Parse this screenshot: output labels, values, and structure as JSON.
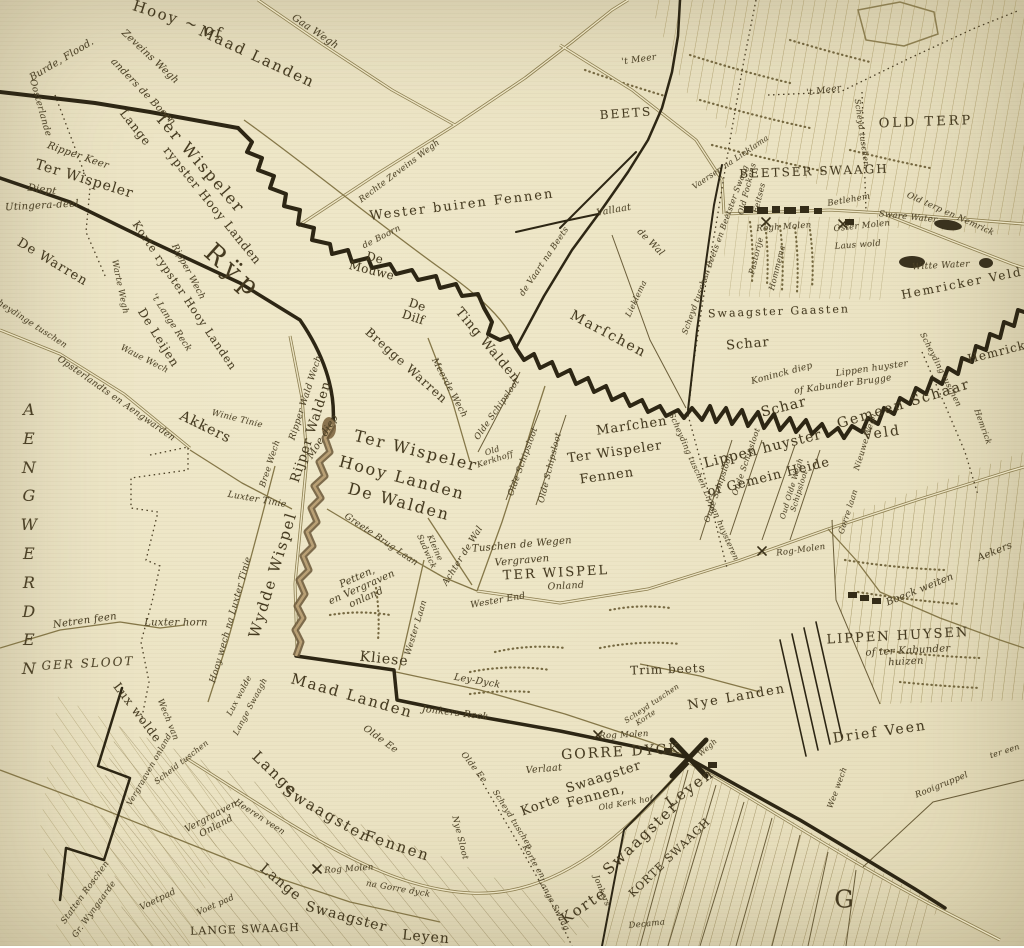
{
  "colors": {
    "paper": "#ebe3c3",
    "ink": "#453a20",
    "dark": "#2d2614",
    "road": "#8c7e50",
    "hatch": "#a08f58",
    "stream": "#6d5a3a"
  },
  "labels": [
    {
      "t": "Hooy ~ of",
      "x": 178,
      "y": 20,
      "r": 18,
      "s": 15,
      "ls": 2
    },
    {
      "t": "Maad Landen",
      "x": 257,
      "y": 57,
      "r": 25,
      "s": 15,
      "ls": 2
    },
    {
      "t": "Gaa Wegh",
      "x": 315,
      "y": 32,
      "r": 34,
      "s": 10,
      "i": 1
    },
    {
      "t": "Burde, Flood.",
      "x": 62,
      "y": 60,
      "r": -31,
      "s": 10,
      "i": 1
    },
    {
      "t": "Zeveins Wegh",
      "x": 150,
      "y": 57,
      "r": 43,
      "s": 10,
      "i": 1
    },
    {
      "t": "anders de Boorn",
      "x": 143,
      "y": 92,
      "r": 46,
      "s": 10,
      "i": 1
    },
    {
      "t": "Oosterlande",
      "x": 40,
      "y": 108,
      "r": 74,
      "s": 9,
      "i": 1
    },
    {
      "t": "Ripper Keer",
      "x": 78,
      "y": 156,
      "r": 19,
      "s": 10,
      "i": 1
    },
    {
      "t": "Ter Wispeler",
      "x": 84,
      "y": 180,
      "r": 17,
      "s": 14,
      "ls": 1
    },
    {
      "t": "Lange",
      "x": 135,
      "y": 128,
      "r": 52,
      "s": 12,
      "ls": 1
    },
    {
      "t": "Ter Wispeler",
      "x": 200,
      "y": 163,
      "r": 49,
      "s": 16,
      "ls": 2
    },
    {
      "t": "rypster Hooy Landen",
      "x": 212,
      "y": 206,
      "r": 51,
      "s": 12,
      "ls": 1
    },
    {
      "t": "Korte rypster Hooy Landen",
      "x": 184,
      "y": 296,
      "r": 56,
      "s": 11,
      "ls": 1
    },
    {
      "t": "'t Lange Reck",
      "x": 171,
      "y": 323,
      "r": 57,
      "s": 9,
      "i": 1
    },
    {
      "t": "Ripper Wech",
      "x": 188,
      "y": 272,
      "r": 62,
      "s": 9,
      "i": 1
    },
    {
      "t": "Diept",
      "x": 42,
      "y": 190,
      "r": 8,
      "s": 10,
      "i": 1
    },
    {
      "t": "Utingera-deel",
      "x": 42,
      "y": 206,
      "r": -3,
      "s": 10,
      "i": 1
    },
    {
      "t": "De Warren",
      "x": 52,
      "y": 263,
      "r": 31,
      "s": 13,
      "ls": 1
    },
    {
      "t": "Rÿp",
      "x": 233,
      "y": 272,
      "r": 42,
      "s": 26,
      "ls": 6
    },
    {
      "t": "De Leijen",
      "x": 158,
      "y": 338,
      "r": 58,
      "s": 12,
      "ls": 1
    },
    {
      "t": "Warte Wegh",
      "x": 119,
      "y": 287,
      "r": 78,
      "s": 8.5,
      "i": 1
    },
    {
      "t": "Waue Wech",
      "x": 144,
      "y": 360,
      "r": 27,
      "s": 8.5,
      "i": 1
    },
    {
      "t": "Scheydinge tuschen",
      "x": 27,
      "y": 322,
      "r": 33,
      "s": 8.5,
      "i": 1
    },
    {
      "t": "Opsterlandts en Aengwarden",
      "x": 116,
      "y": 399,
      "r": 35,
      "s": 9,
      "i": 1
    },
    {
      "t": "Akkers",
      "x": 205,
      "y": 428,
      "r": 26,
      "s": 14,
      "ls": 1
    },
    {
      "t": "Winie Tinie",
      "x": 237,
      "y": 420,
      "r": 14,
      "s": 8.5,
      "i": 1
    },
    {
      "t": "Bree Wech",
      "x": 271,
      "y": 464,
      "r": -72,
      "s": 8.5,
      "i": 1
    },
    {
      "t": "Ripper Wald Wech",
      "x": 306,
      "y": 398,
      "r": -72,
      "s": 9,
      "i": 1
    },
    {
      "t": "Rijper Walden",
      "x": 312,
      "y": 432,
      "r": -72,
      "s": 13,
      "ls": 1
    },
    {
      "t": "Moe diep",
      "x": 323,
      "y": 437,
      "r": -58,
      "s": 10,
      "i": 1
    },
    {
      "t": "Wydde Wispel",
      "x": 273,
      "y": 575,
      "r": -73,
      "s": 15,
      "ls": 2
    },
    {
      "t": "Luxter Tinie",
      "x": 257,
      "y": 500,
      "r": 10,
      "s": 9,
      "i": 1
    },
    {
      "t": "Hooy wech na Luxter Tinie",
      "x": 231,
      "y": 620,
      "r": -74,
      "s": 9,
      "i": 1
    },
    {
      "t": "Luxter horn",
      "x": 176,
      "y": 623,
      "r": 0,
      "s": 10,
      "i": 1
    },
    {
      "t": "Netren feen",
      "x": 85,
      "y": 621,
      "r": -8,
      "s": 10,
      "i": 1
    },
    {
      "t": "GER SLOOT",
      "x": 88,
      "y": 664,
      "r": -3,
      "s": 12,
      "ls": 2,
      "i": 1
    },
    {
      "t": "Lux wolde",
      "x": 137,
      "y": 713,
      "r": 53,
      "s": 12,
      "ls": 1
    },
    {
      "t": "Wech van",
      "x": 167,
      "y": 720,
      "r": 68,
      "s": 8.5,
      "i": 1
    },
    {
      "t": "Scheid tuschen",
      "x": 182,
      "y": 763,
      "r": -38,
      "s": 8,
      "i": 1
    },
    {
      "t": "Vergraaven\nOnland",
      "x": 214,
      "y": 822,
      "r": -28,
      "s": 9.5,
      "i": 1
    },
    {
      "t": "Vergraaven onland",
      "x": 150,
      "y": 770,
      "r": -60,
      "s": 8,
      "i": 1
    },
    {
      "t": "Statten Roschen",
      "x": 86,
      "y": 893,
      "r": -54,
      "s": 8.5,
      "i": 1
    },
    {
      "t": "Gr. Wyngaarde",
      "x": 95,
      "y": 910,
      "r": -54,
      "s": 8.5,
      "i": 1
    },
    {
      "t": "Voetpad",
      "x": 158,
      "y": 900,
      "r": -26,
      "s": 9,
      "i": 1
    },
    {
      "t": "Maad Landen",
      "x": 352,
      "y": 696,
      "r": 16,
      "s": 15,
      "ls": 2
    },
    {
      "t": "Olde Ee",
      "x": 380,
      "y": 740,
      "r": 36,
      "s": 9.5,
      "i": 1
    },
    {
      "t": "Jonkers Reck",
      "x": 455,
      "y": 714,
      "r": 7,
      "s": 9.5,
      "i": 1
    },
    {
      "t": "Ley-Dyck",
      "x": 477,
      "y": 682,
      "r": 10,
      "s": 9.5,
      "i": 1
    },
    {
      "t": "Kliese",
      "x": 384,
      "y": 660,
      "r": 6,
      "s": 14,
      "ls": 1
    },
    {
      "t": "Wester Laan",
      "x": 417,
      "y": 628,
      "r": -73,
      "s": 8.5,
      "i": 1
    },
    {
      "t": "Greete Brug Laan",
      "x": 381,
      "y": 540,
      "r": 34,
      "s": 9,
      "i": 1
    },
    {
      "t": "Kleine\nSudwick",
      "x": 430,
      "y": 550,
      "r": 66,
      "s": 8,
      "i": 1
    },
    {
      "t": "Achter de Wal",
      "x": 463,
      "y": 556,
      "r": -58,
      "s": 9,
      "i": 1
    },
    {
      "t": "Petten,\nen Vergraven\nonland",
      "x": 362,
      "y": 588,
      "r": -24,
      "s": 10,
      "i": 1
    },
    {
      "t": "Ter Wispeler",
      "x": 416,
      "y": 451,
      "r": 14,
      "s": 16,
      "ls": 2
    },
    {
      "t": "Hooy Landen",
      "x": 402,
      "y": 478,
      "r": 15,
      "s": 16,
      "ls": 2
    },
    {
      "t": "De Walden",
      "x": 399,
      "y": 502,
      "r": 15,
      "s": 16,
      "ls": 2
    },
    {
      "t": "De\nMouwe",
      "x": 373,
      "y": 265,
      "r": 14,
      "s": 12
    },
    {
      "t": "De\nDilf",
      "x": 415,
      "y": 312,
      "r": 18,
      "s": 12
    },
    {
      "t": "Bregge Warren",
      "x": 406,
      "y": 366,
      "r": 42,
      "s": 12,
      "ls": 1
    },
    {
      "t": "Meerde Wech",
      "x": 449,
      "y": 388,
      "r": 62,
      "s": 9,
      "i": 1
    },
    {
      "t": "Ting Walden",
      "x": 487,
      "y": 346,
      "r": 50,
      "s": 13,
      "ls": 1
    },
    {
      "t": "Olde Schipsloot",
      "x": 498,
      "y": 410,
      "r": -55,
      "s": 8.5,
      "i": 1
    },
    {
      "t": "Olde Schipsloot",
      "x": 524,
      "y": 462,
      "r": -70,
      "s": 8.5,
      "i": 1
    },
    {
      "t": "Olde Schipsloot",
      "x": 551,
      "y": 468,
      "r": -76,
      "s": 8.5,
      "i": 1
    },
    {
      "t": "Old\nKerkhoff",
      "x": 494,
      "y": 456,
      "r": -18,
      "s": 8,
      "i": 1
    },
    {
      "t": "Marſchen",
      "x": 608,
      "y": 335,
      "r": 28,
      "s": 14,
      "ls": 2
    },
    {
      "t": "Marſchen",
      "x": 632,
      "y": 427,
      "r": -8,
      "s": 13,
      "ls": 1
    },
    {
      "t": "Ter Wispeler",
      "x": 615,
      "y": 453,
      "r": -8,
      "s": 13,
      "ls": 1
    },
    {
      "t": "Fennen",
      "x": 607,
      "y": 477,
      "r": -8,
      "s": 13,
      "ls": 1
    },
    {
      "t": "de Vaart na Beets",
      "x": 545,
      "y": 262,
      "r": -56,
      "s": 8.5,
      "i": 1
    },
    {
      "t": "Wester buiren Fennen",
      "x": 462,
      "y": 206,
      "r": -7,
      "s": 13,
      "ls": 2
    },
    {
      "t": "Rechte Zeveins Wegh",
      "x": 400,
      "y": 172,
      "r": -37,
      "s": 8.5,
      "i": 1
    },
    {
      "t": "de Boorn",
      "x": 382,
      "y": 238,
      "r": -27,
      "s": 8.5,
      "i": 1
    },
    {
      "t": "BEETS",
      "x": 626,
      "y": 114,
      "r": -4,
      "s": 12,
      "ls": 2
    },
    {
      "t": "Vallaat",
      "x": 614,
      "y": 211,
      "r": -10,
      "s": 9.5,
      "i": 1
    },
    {
      "t": "de Wal",
      "x": 650,
      "y": 243,
      "r": 45,
      "s": 9.5,
      "i": 1
    },
    {
      "t": "Lieklema",
      "x": 637,
      "y": 299,
      "r": -65,
      "s": 8,
      "i": 1
    },
    {
      "t": "Scheyd tuschen Beets en Beetster Swaag",
      "x": 716,
      "y": 250,
      "r": -70,
      "s": 8,
      "i": 1
    },
    {
      "t": "Vaersen na Lieklama",
      "x": 731,
      "y": 163,
      "r": -34,
      "s": 8,
      "i": 1
    },
    {
      "t": "Old Fockens",
      "x": 748,
      "y": 189,
      "r": -76,
      "s": 8,
      "i": 1
    },
    {
      "t": "Feitses",
      "x": 760,
      "y": 198,
      "r": -76,
      "s": 8,
      "i": 1
    },
    {
      "t": "Pastorije",
      "x": 757,
      "y": 256,
      "r": -76,
      "s": 8,
      "i": 1
    },
    {
      "t": "Hommema",
      "x": 778,
      "y": 268,
      "r": -76,
      "s": 8,
      "i": 1
    },
    {
      "t": "BEETSER SWAAGH",
      "x": 814,
      "y": 172,
      "r": -2,
      "s": 12,
      "ls": 2
    },
    {
      "t": "OLD TERP",
      "x": 926,
      "y": 123,
      "r": -2,
      "s": 13,
      "ls": 3
    },
    {
      "t": "'t Meer",
      "x": 639,
      "y": 60,
      "r": -8,
      "s": 9,
      "i": 1
    },
    {
      "t": "'t Meer",
      "x": 824,
      "y": 91,
      "r": -8,
      "s": 9,
      "i": 1
    },
    {
      "t": "Scheyd tuschen",
      "x": 861,
      "y": 133,
      "r": 82,
      "s": 8,
      "i": 1
    },
    {
      "t": "Betlehem",
      "x": 849,
      "y": 201,
      "r": -10,
      "s": 8.5,
      "i": 1
    },
    {
      "t": "Rogh Molen",
      "x": 784,
      "y": 228,
      "r": -4,
      "s": 8.5,
      "i": 1
    },
    {
      "t": "Oster Molen",
      "x": 862,
      "y": 227,
      "r": -6,
      "s": 8.5,
      "i": 1
    },
    {
      "t": "Laus wold",
      "x": 858,
      "y": 246,
      "r": -4,
      "s": 8.5,
      "i": 1
    },
    {
      "t": "Sware Water",
      "x": 908,
      "y": 218,
      "r": 6,
      "s": 8.5,
      "i": 1
    },
    {
      "t": "Old terp en Nemrick",
      "x": 950,
      "y": 215,
      "r": 24,
      "s": 8.5,
      "i": 1
    },
    {
      "t": "Witte Water",
      "x": 941,
      "y": 266,
      "r": -3,
      "s": 9,
      "i": 1
    },
    {
      "t": "Hemricker Veld",
      "x": 962,
      "y": 284,
      "r": -11,
      "s": 12,
      "ls": 2
    },
    {
      "t": "Hemricker",
      "x": 1004,
      "y": 351,
      "r": -14,
      "s": 12,
      "ls": 1
    },
    {
      "t": "Swaagster Gaasten",
      "x": 779,
      "y": 312,
      "r": -2,
      "s": 11,
      "ls": 2
    },
    {
      "t": "Schar",
      "x": 748,
      "y": 345,
      "r": -5,
      "s": 13,
      "ls": 1
    },
    {
      "t": "Koninck diep",
      "x": 782,
      "y": 374,
      "r": -15,
      "s": 9,
      "i": 1
    },
    {
      "t": "Lippen huyster",
      "x": 872,
      "y": 369,
      "r": -8,
      "s": 9,
      "i": 1
    },
    {
      "t": "of Kabunder Brugge",
      "x": 843,
      "y": 385,
      "r": -8,
      "s": 9,
      "i": 1
    },
    {
      "t": "Schar",
      "x": 784,
      "y": 408,
      "r": -14,
      "s": 14,
      "ls": 1
    },
    {
      "t": "Gemeen Schaar",
      "x": 904,
      "y": 405,
      "r": -17,
      "s": 14,
      "ls": 2
    },
    {
      "t": "Veld",
      "x": 882,
      "y": 434,
      "r": -8,
      "s": 14,
      "ls": 2
    },
    {
      "t": "Scheyding tuschen",
      "x": 940,
      "y": 370,
      "r": 63,
      "s": 8,
      "i": 1
    },
    {
      "t": "Hemrick",
      "x": 982,
      "y": 427,
      "r": 70,
      "s": 8,
      "i": 1
    },
    {
      "t": "Nieuwe Wegh",
      "x": 866,
      "y": 442,
      "r": -73,
      "s": 8,
      "i": 1
    },
    {
      "t": "Oude Schipsloot",
      "x": 719,
      "y": 489,
      "r": -71,
      "s": 8,
      "i": 1
    },
    {
      "t": "Oude Schipsloot",
      "x": 747,
      "y": 462,
      "r": -71,
      "s": 8,
      "i": 1
    },
    {
      "t": "Oud Olde Wegh\nSchipsloot",
      "x": 796,
      "y": 490,
      "r": -73,
      "s": 7.5,
      "i": 1
    },
    {
      "t": "Scheyding tuschen Lippen huysteren",
      "x": 703,
      "y": 487,
      "r": 66,
      "s": 8,
      "i": 1
    },
    {
      "t": "Lippen huyster",
      "x": 763,
      "y": 450,
      "r": -14,
      "s": 14,
      "ls": 1
    },
    {
      "t": "of Gemein Heide",
      "x": 769,
      "y": 478,
      "r": -14,
      "s": 13,
      "ls": 1
    },
    {
      "t": "Rog-Molen",
      "x": 801,
      "y": 551,
      "r": -8,
      "s": 8.5,
      "i": 1
    },
    {
      "t": "Gorre laan",
      "x": 849,
      "y": 512,
      "r": -72,
      "s": 8,
      "i": 1
    },
    {
      "t": "Tuschen de Wegen",
      "x": 522,
      "y": 545,
      "r": -5,
      "s": 10,
      "i": 1
    },
    {
      "t": "Vergraven",
      "x": 522,
      "y": 561,
      "r": -5,
      "s": 10,
      "i": 1
    },
    {
      "t": "TER WISPEL",
      "x": 556,
      "y": 574,
      "r": -3,
      "s": 13,
      "ls": 2
    },
    {
      "t": "Onland",
      "x": 566,
      "y": 587,
      "r": -3,
      "s": 9.5,
      "i": 1
    },
    {
      "t": "Wester End",
      "x": 498,
      "y": 601,
      "r": -10,
      "s": 9,
      "i": 1
    },
    {
      "t": "Trim beets",
      "x": 668,
      "y": 670,
      "r": -2,
      "s": 12,
      "ls": 1
    },
    {
      "t": "Nye Landen",
      "x": 737,
      "y": 698,
      "r": -10,
      "s": 13,
      "ls": 2
    },
    {
      "t": "LIPPEN HUYSEN",
      "x": 898,
      "y": 637,
      "r": -3,
      "s": 13,
      "ls": 2
    },
    {
      "t": "of ter Kabunder",
      "x": 908,
      "y": 651,
      "r": -3,
      "s": 10,
      "i": 1
    },
    {
      "t": "huizen",
      "x": 906,
      "y": 662,
      "r": -3,
      "s": 10,
      "i": 1
    },
    {
      "t": "Boeck weiten",
      "x": 920,
      "y": 590,
      "r": -22,
      "s": 10,
      "i": 1
    },
    {
      "t": "Aekers",
      "x": 995,
      "y": 552,
      "r": -22,
      "s": 10,
      "i": 1
    },
    {
      "t": "Drief Veen",
      "x": 880,
      "y": 733,
      "r": -8,
      "s": 14,
      "ls": 2
    },
    {
      "t": "Rooigruppel",
      "x": 942,
      "y": 786,
      "r": -22,
      "s": 8.5,
      "i": 1
    },
    {
      "t": "ter een",
      "x": 1005,
      "y": 752,
      "r": -18,
      "s": 8,
      "i": 1
    },
    {
      "t": "Wee wech",
      "x": 838,
      "y": 788,
      "r": -70,
      "s": 8,
      "i": 1
    },
    {
      "t": "GORRE DYCK",
      "x": 621,
      "y": 753,
      "r": -3,
      "s": 14,
      "ls": 2
    },
    {
      "t": "Rog Molen",
      "x": 624,
      "y": 736,
      "r": -3,
      "s": 8.5,
      "i": 1
    },
    {
      "t": "Verlaat",
      "x": 544,
      "y": 770,
      "r": -5,
      "s": 9.5,
      "i": 1
    },
    {
      "t": "Korte",
      "x": 541,
      "y": 806,
      "r": -20,
      "s": 13,
      "ls": 1
    },
    {
      "t": "Swaagster",
      "x": 604,
      "y": 778,
      "r": -18,
      "s": 13,
      "ls": 1
    },
    {
      "t": "Fennen,",
      "x": 596,
      "y": 797,
      "r": -15,
      "s": 13,
      "ls": 1
    },
    {
      "t": "Old Kerk hof",
      "x": 626,
      "y": 804,
      "r": -10,
      "s": 8,
      "i": 1
    },
    {
      "t": "Leyen",
      "x": 690,
      "y": 788,
      "r": -36,
      "s": 15,
      "ls": 2
    },
    {
      "t": "Swaagster",
      "x": 641,
      "y": 838,
      "r": -44,
      "s": 15,
      "ls": 2
    },
    {
      "t": "Korte",
      "x": 584,
      "y": 906,
      "r": -34,
      "s": 15,
      "ls": 2
    },
    {
      "t": "KORTE SWAAGH",
      "x": 670,
      "y": 858,
      "r": -44,
      "s": 11,
      "ls": 1
    },
    {
      "t": "Scheyd tuschen",
      "x": 512,
      "y": 820,
      "r": 58,
      "s": 8,
      "i": 1
    },
    {
      "t": "Korte en",
      "x": 533,
      "y": 862,
      "r": 60,
      "s": 8,
      "i": 1
    },
    {
      "t": "Lange Swaag",
      "x": 553,
      "y": 905,
      "r": 62,
      "s": 8,
      "i": 1
    },
    {
      "t": "Olde Ee",
      "x": 473,
      "y": 768,
      "r": 52,
      "s": 8.5,
      "i": 1
    },
    {
      "t": "Nye Sloot",
      "x": 459,
      "y": 838,
      "r": 76,
      "s": 8.5,
      "i": 1
    },
    {
      "t": "Jonkers",
      "x": 601,
      "y": 891,
      "r": 68,
      "s": 8,
      "i": 1
    },
    {
      "t": "Decama",
      "x": 647,
      "y": 925,
      "r": -6,
      "s": 8.5,
      "i": 1
    },
    {
      "t": "Scheyd tuschen",
      "x": 652,
      "y": 704,
      "r": -34,
      "s": 7.5,
      "i": 1
    },
    {
      "t": "Korte",
      "x": 646,
      "y": 718,
      "r": -34,
      "s": 7.5,
      "i": 1
    },
    {
      "t": "Wegh",
      "x": 708,
      "y": 748,
      "r": -42,
      "s": 7.5,
      "i": 1
    },
    {
      "t": "Lange",
      "x": 275,
      "y": 774,
      "r": 44,
      "s": 15,
      "ls": 2
    },
    {
      "t": "Swaagster",
      "x": 326,
      "y": 814,
      "r": 30,
      "s": 15,
      "ls": 2
    },
    {
      "t": "Fennen",
      "x": 397,
      "y": 846,
      "r": 18,
      "s": 15,
      "ls": 2
    },
    {
      "t": "Heeren veen",
      "x": 259,
      "y": 818,
      "r": 33,
      "s": 8.5,
      "i": 1
    },
    {
      "t": "Rog Molen",
      "x": 349,
      "y": 870,
      "r": -4,
      "s": 8.5,
      "i": 1
    },
    {
      "t": "na Gorre dyck",
      "x": 398,
      "y": 890,
      "r": 10,
      "s": 8.5,
      "i": 1
    },
    {
      "t": "Lange",
      "x": 280,
      "y": 883,
      "r": 40,
      "s": 14,
      "ls": 1
    },
    {
      "t": "Swaagster",
      "x": 346,
      "y": 918,
      "r": 15,
      "s": 14,
      "ls": 1
    },
    {
      "t": "Leyen",
      "x": 426,
      "y": 938,
      "r": 5,
      "s": 14,
      "ls": 1
    },
    {
      "t": "LANGE SWAAGH",
      "x": 245,
      "y": 930,
      "r": -2,
      "s": 11,
      "ls": 1
    },
    {
      "t": "Voet pad",
      "x": 216,
      "y": 906,
      "r": -24,
      "s": 8.5,
      "i": 1
    },
    {
      "t": "A\nE\nN\nG\nW\nE\nR\nD\nE\nN",
      "x": 29,
      "y": 540,
      "r": 0,
      "s": 16,
      "lh": 1.8,
      "i": 1,
      "n": "region-name-aengwerden"
    },
    {
      "t": "G",
      "x": 845,
      "y": 900,
      "r": 0,
      "s": 24,
      "ls": 2,
      "n": "region-letter-g"
    },
    {
      "t": "Lux wolde",
      "x": 240,
      "y": 696,
      "r": -62,
      "s": 8,
      "i": 1
    },
    {
      "t": "Lange Swaagh",
      "x": 251,
      "y": 707,
      "r": -62,
      "s": 8,
      "i": 1
    }
  ]
}
